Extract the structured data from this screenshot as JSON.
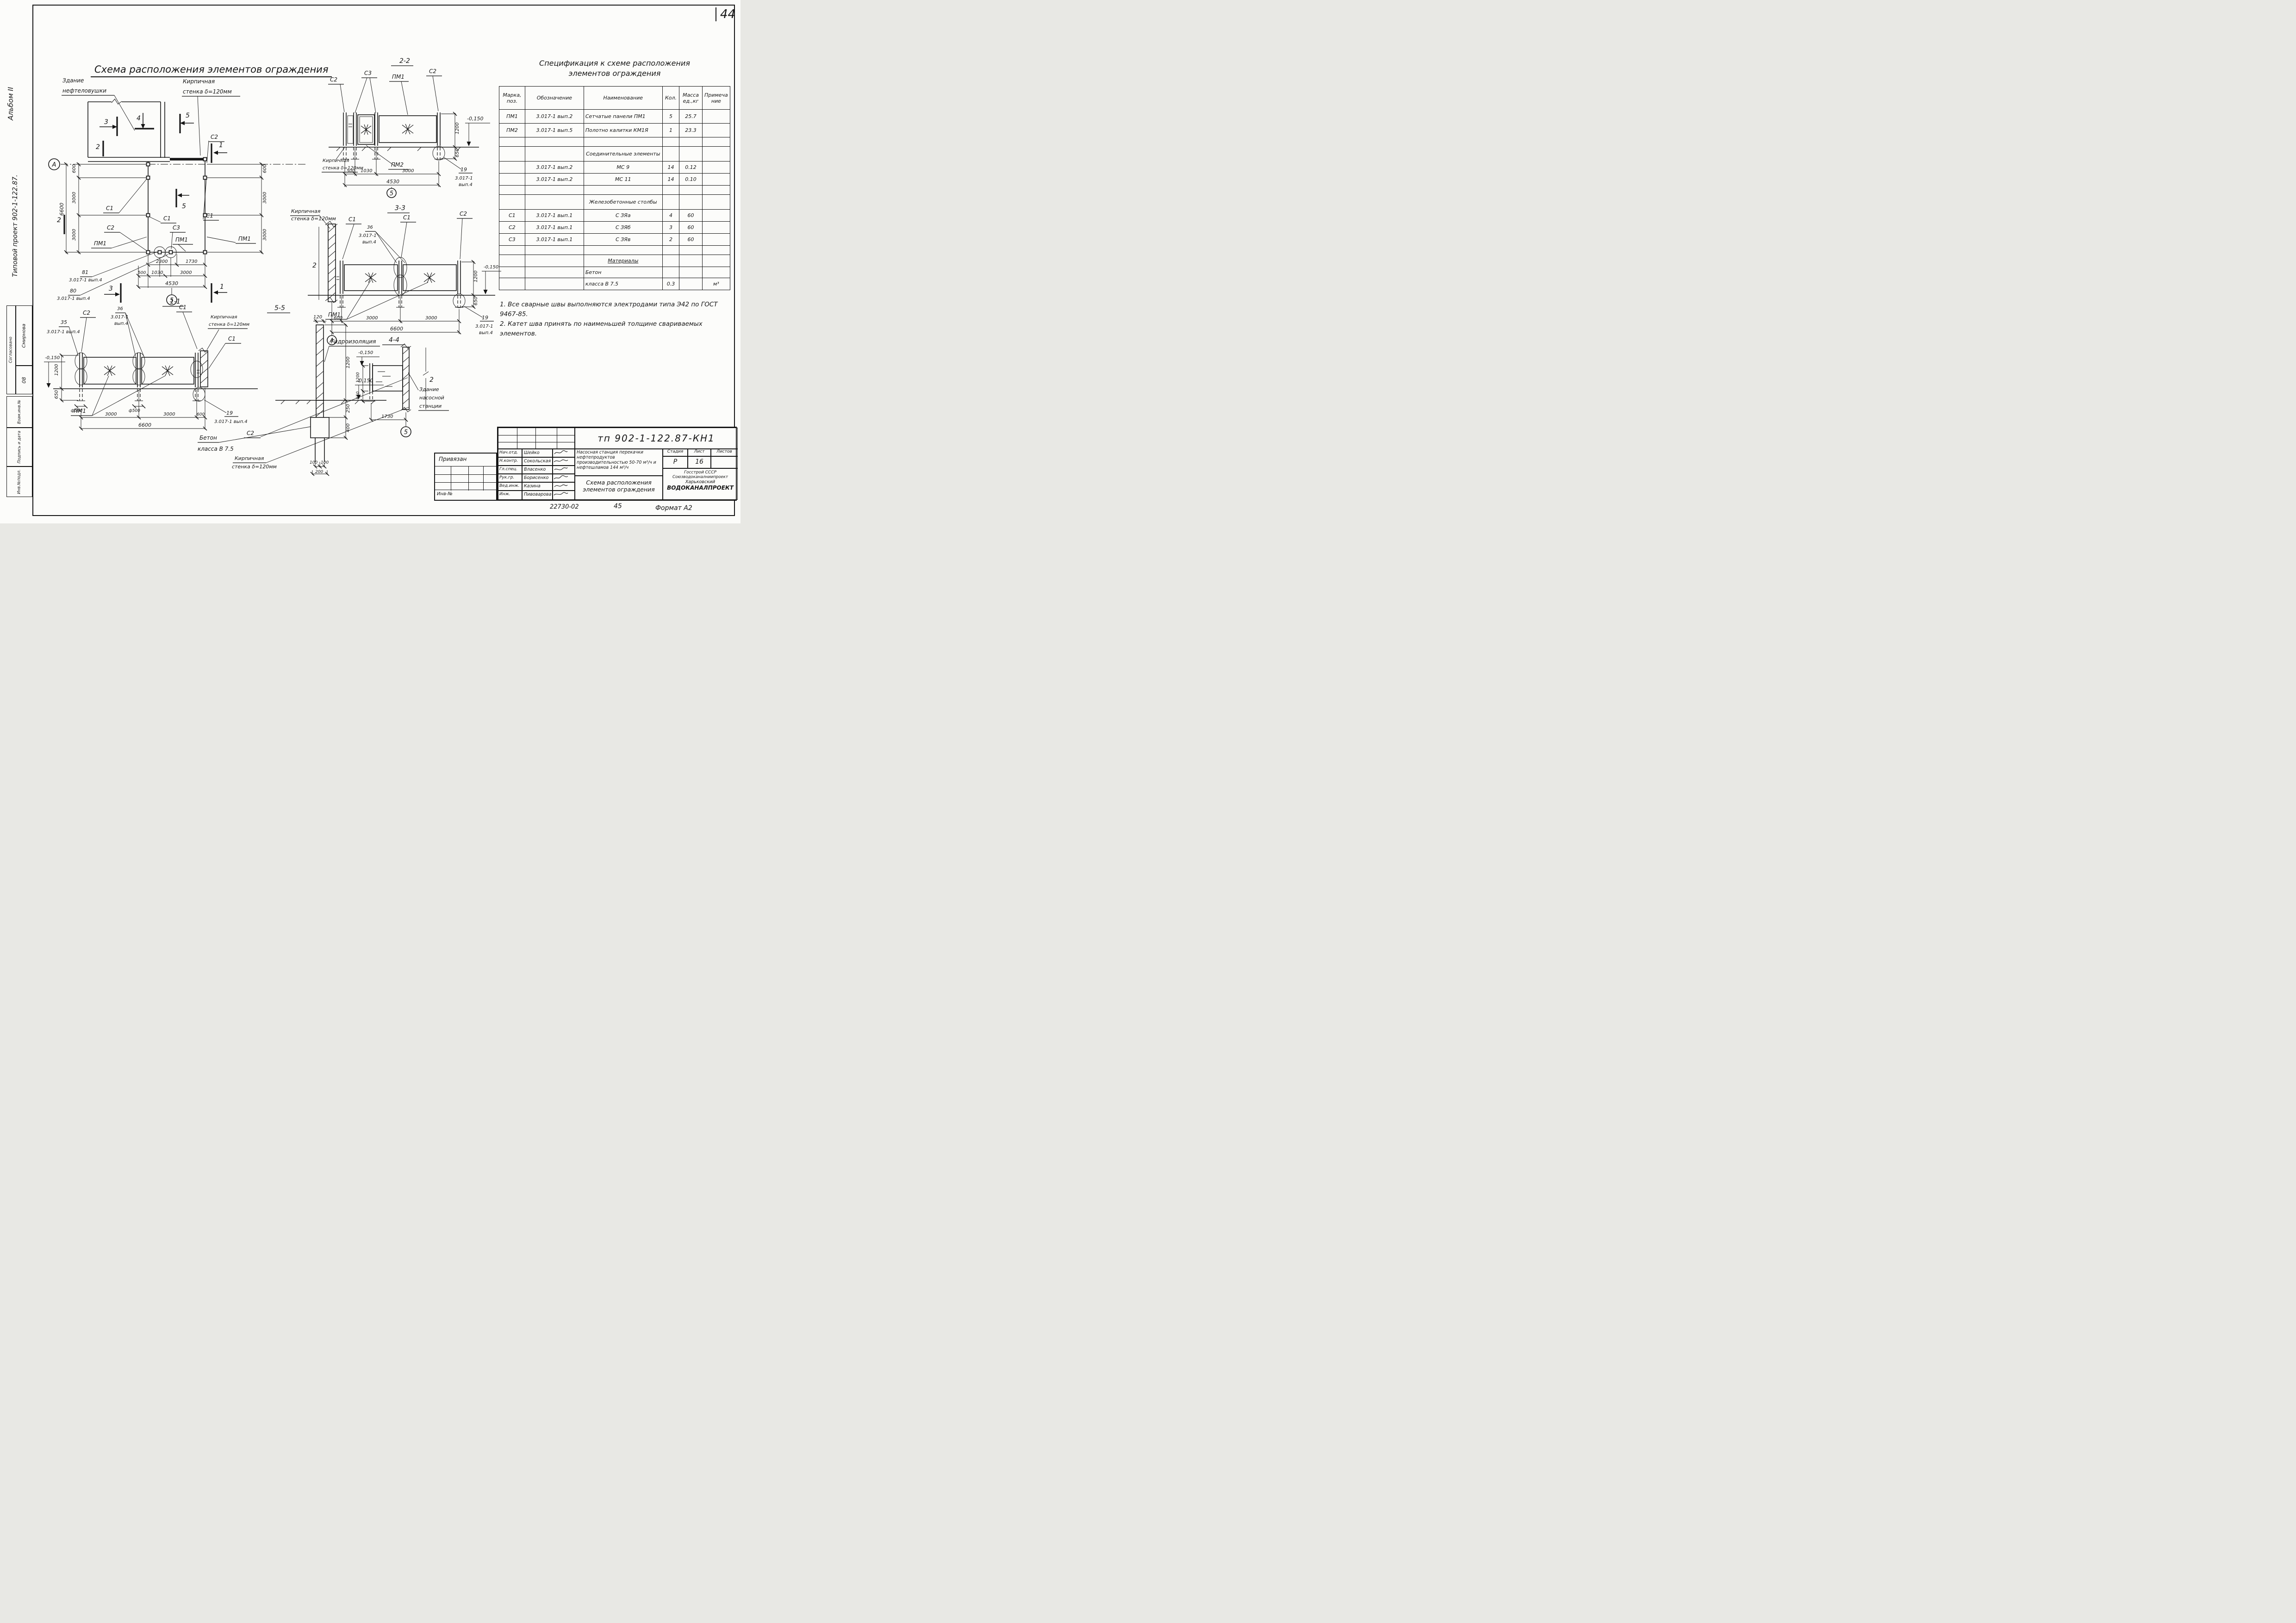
{
  "page": {
    "number": "44"
  },
  "margin": {
    "album": "Альбом II",
    "project": "Типовой проект 902-1-122.87.",
    "agreed": "Согласовано",
    "agreed_name": "Смирнова",
    "dept": "08",
    "vzam": "Взам.инв.№",
    "sign_date": "Подпись и дата",
    "inv_podl": "Инв.№подл."
  },
  "titles": {
    "main": "Схема расположения элементов ограждения"
  },
  "sections": {
    "s11": "1-1",
    "s22": "2-2",
    "s33": "3-3",
    "s44": "4-4",
    "s55": "5-5"
  },
  "labels": {
    "a": "А",
    "c1": "С1",
    "c2": "С2",
    "c3": "С3",
    "pm1": "ПМ1",
    "pm2": "ПМ2",
    "m1": "1",
    "m2": "2",
    "m3": "3",
    "m4": "4",
    "m5": "5",
    "n19": "19",
    "n35": "35",
    "n36": "36",
    "n80": "80",
    "n81": "81",
    "ref": "3.017-1",
    "vyp4": "вып.4",
    "ref_vyp4": "3.017-1 вып.4"
  },
  "plan": {
    "building1": "Здание",
    "building2": "нефтеловушки",
    "brick1": "Кирпичная",
    "brick2": "стенка δ=120мм"
  },
  "misc": {
    "gidro": "Гидроизоляция",
    "beton1": "Бетон",
    "beton2": "класса В 7.5",
    "pump1": "Здание",
    "pump2": "насосной",
    "pump3": "станции"
  },
  "dims": {
    "d100": "100",
    "d120": "120",
    "d200": "200",
    "d250": "250",
    "d400": "400",
    "d500": "500",
    "d600": "600",
    "d650": "650",
    "d1030": "1030",
    "d1200": "1200",
    "d1730": "1730",
    "d2300": "2300",
    "d3000": "3000",
    "d4530": "4530",
    "d6600": "6600",
    "f500": "ф500",
    "lvl": "-0,150"
  },
  "spec": {
    "title1": "Спецификация к схеме расположения",
    "title2": "элементов ограждения",
    "h": [
      "Марка, поз.",
      "Обозначение",
      "Наименование",
      "Кол.",
      "Масса ед.,кг",
      "Примечание"
    ],
    "rows": [
      [
        "ПМ1",
        "3.017-1 вып.2",
        "Сетчатые панели  ПМ1",
        "5",
        "25.7",
        ""
      ],
      [
        "ПМ2",
        "3.017-1 вып.5",
        "Полотно калитки  КМ1Я",
        "1",
        "23.3",
        ""
      ],
      [
        "",
        "",
        "",
        "",
        "",
        ""
      ],
      [
        "",
        "",
        "Соединительные элементы",
        "",
        "",
        ""
      ],
      [
        "",
        "3.017-1 вып.2",
        "МС 9",
        "14",
        "0.12",
        ""
      ],
      [
        "",
        "3.017-1 вып.2",
        "МС 11",
        "14",
        "0.10",
        ""
      ],
      [
        "",
        "",
        "",
        "",
        "",
        ""
      ],
      [
        "",
        "",
        "Железобетонные столбы",
        "",
        "",
        ""
      ],
      [
        "С1",
        "3.017-1 вып.1",
        "С ЗЯа",
        "4",
        "60",
        ""
      ],
      [
        "С2",
        "3.017-1 вып.1",
        "С ЗЯб",
        "3",
        "60",
        ""
      ],
      [
        "С3",
        "3.017-1 вып.1",
        "С ЗЯв",
        "2",
        "60",
        ""
      ],
      [
        "",
        "",
        "",
        "",
        "",
        ""
      ],
      [
        "",
        "",
        "Материалы",
        "",
        "",
        ""
      ],
      [
        "",
        "",
        "Бетон",
        "",
        "",
        ""
      ],
      [
        "",
        "",
        "класса В 7.5",
        "0.3",
        "",
        "м³"
      ]
    ]
  },
  "notes": {
    "n1": "1. Все сварные швы выполняются электродами типа Э42 по ГОСТ 9467-85.",
    "n2": "2. Катет шва принять по наименьшей толщине свариваемых элементов."
  },
  "tb": {
    "doc": "тп 902-1-122.87-КН1",
    "roles": [
      {
        "r": "Нач.отд.",
        "n": "Шейко"
      },
      {
        "r": "Н.контр.",
        "n": "Сокольская"
      },
      {
        "r": "Гл.спец.",
        "n": "Власенко"
      },
      {
        "r": "Рук.гр.",
        "n": "Борисенко"
      },
      {
        "r": "Вед.инж.",
        "n": "Казина"
      },
      {
        "r": "Инж.",
        "n": "Пивоварова"
      }
    ],
    "project": "Насосная станция перекачки нефтепродуктов производительностью 50-70 м³/ч и нефтешламов 144 м³/ч",
    "t1": "Схема расположения",
    "t2": "элементов ограждения",
    "stage_l": "Стадия",
    "list_l": "Лист",
    "lists_l": "Листов",
    "stage": "Р",
    "list": "16",
    "lists": "",
    "org1": "Госстрой СССР",
    "org2": "Союзводоканалниипроект",
    "org3": "Харьковский",
    "org4": "ВОДОКАНАЛПРОЕКТ",
    "priv": "Привязан",
    "inv": "Инв-№"
  },
  "footer": {
    "code": "22730-02",
    "num": "45",
    "format": "Формат А2"
  }
}
